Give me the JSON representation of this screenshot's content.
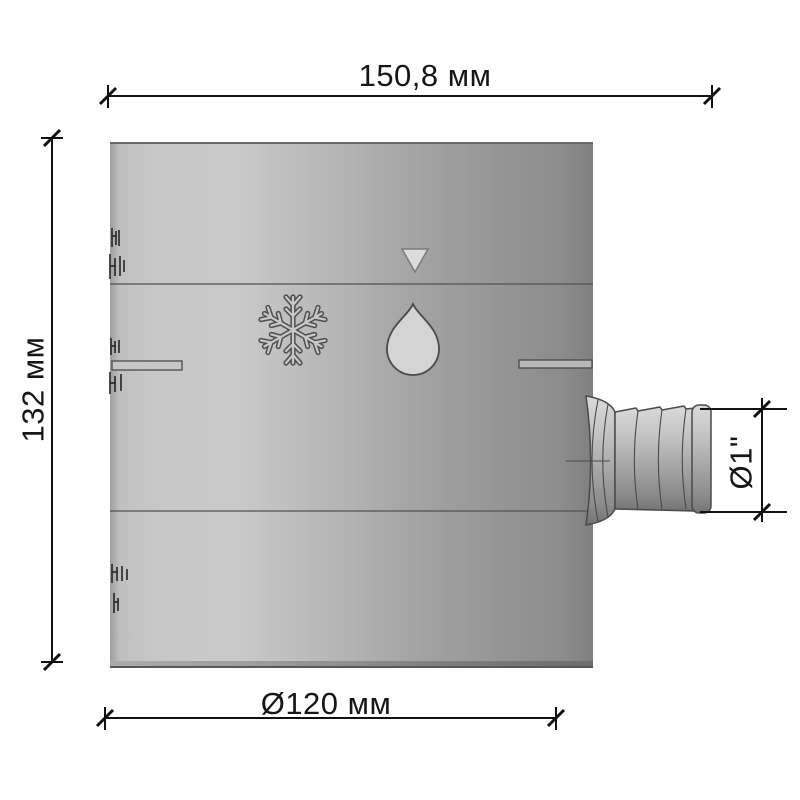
{
  "drawing": {
    "description": "technical drawing of cylindrical water diverter drum with hose outlet",
    "dimensions": {
      "width_top": "150,8 мм",
      "height_left": "132 мм",
      "diameter_bottom": "Ø120 мм",
      "outlet_right": "Ø1\""
    },
    "icons": [
      {
        "name": "down-triangle-marker-icon"
      },
      {
        "name": "snowflake-icon"
      },
      {
        "name": "water-drop-icon"
      }
    ],
    "features": [
      {
        "name": "hose-barb-outlet"
      },
      {
        "name": "left-vent-slot"
      },
      {
        "name": "right-vent-slot"
      },
      {
        "name": "upper-seam-line"
      },
      {
        "name": "lower-seam-line"
      },
      {
        "name": "embossed-mold-text-marks"
      }
    ],
    "colors": {
      "body_light": "#c9c9c9",
      "body_dark": "#7f7f7f",
      "dimension_line": "#111111",
      "icon_fill": "#d6d6d6",
      "engraving": "#4a4a4a"
    }
  }
}
